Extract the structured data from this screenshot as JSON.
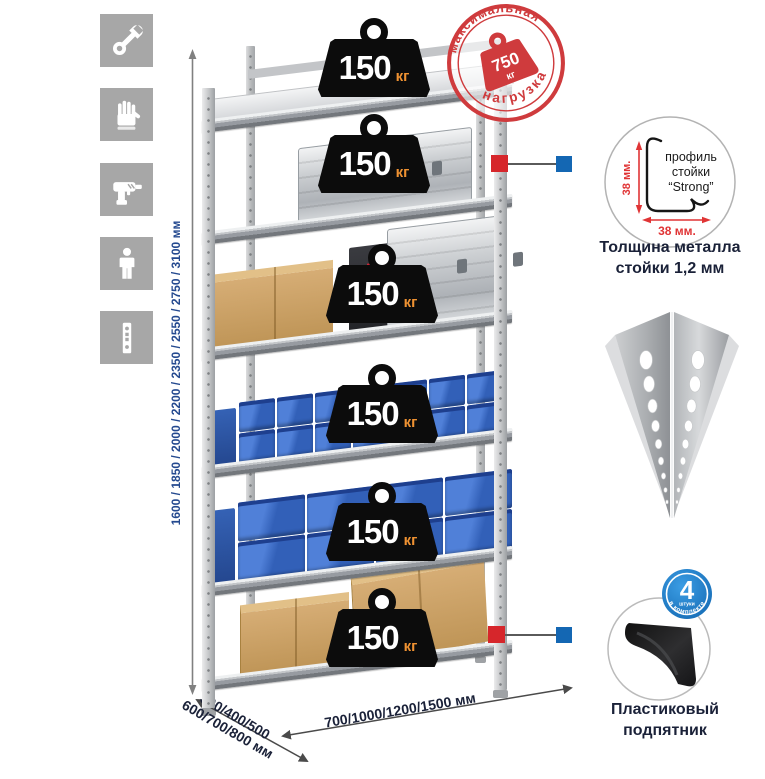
{
  "colors": {
    "accent_red": "#d6262b",
    "accent_blue": "#1467b3",
    "stamp_red": "#cf3b3d",
    "navy_text": "#1a2138",
    "height_text_blue": "#24498f",
    "bin_blue": "#2d5cb8",
    "badge_black": "#0c0c0c",
    "badge_unit_orange": "#ef9232"
  },
  "left_icons": [
    {
      "icon": "wrench-icon"
    },
    {
      "icon": "gloves-icon"
    },
    {
      "icon": "drill-icon"
    },
    {
      "icon": "person-icon"
    },
    {
      "icon": "upright-profile-icon"
    }
  ],
  "height_label": "1600 / 1850 / 2000 / 2200 / 2350 / 2550 / 2750 / 3100 мм",
  "shelves": [
    {
      "load": "150",
      "unit": "кг"
    },
    {
      "load": "150",
      "unit": "кг"
    },
    {
      "load": "150",
      "unit": "кг"
    },
    {
      "load": "150",
      "unit": "кг"
    },
    {
      "load": "150",
      "unit": "кг"
    },
    {
      "load": "150",
      "unit": "кг"
    }
  ],
  "max_load_stamp": {
    "arc_top": "максимальная",
    "arc_bottom": "нагрузка",
    "value": "750",
    "unit": "кг"
  },
  "profile_detail": {
    "label_line1": "профиль",
    "label_line2": "стойки",
    "label_line3": "“Strong”",
    "dim_vertical": "38 мм.",
    "dim_horizontal": "38 мм.",
    "caption_line1": "Толщина металла",
    "caption_line2": "стойки 1,2 мм"
  },
  "foot_detail": {
    "badge_value": "4",
    "badge_sub": "штуки",
    "badge_arc": "в комплекте",
    "caption_line1": "Пластиковый",
    "caption_line2": "подпятник"
  },
  "depth_label_line1": "300/400/500",
  "depth_label_line2": "600/700/800 мм",
  "width_label": "700/1000/1200/1500 мм"
}
